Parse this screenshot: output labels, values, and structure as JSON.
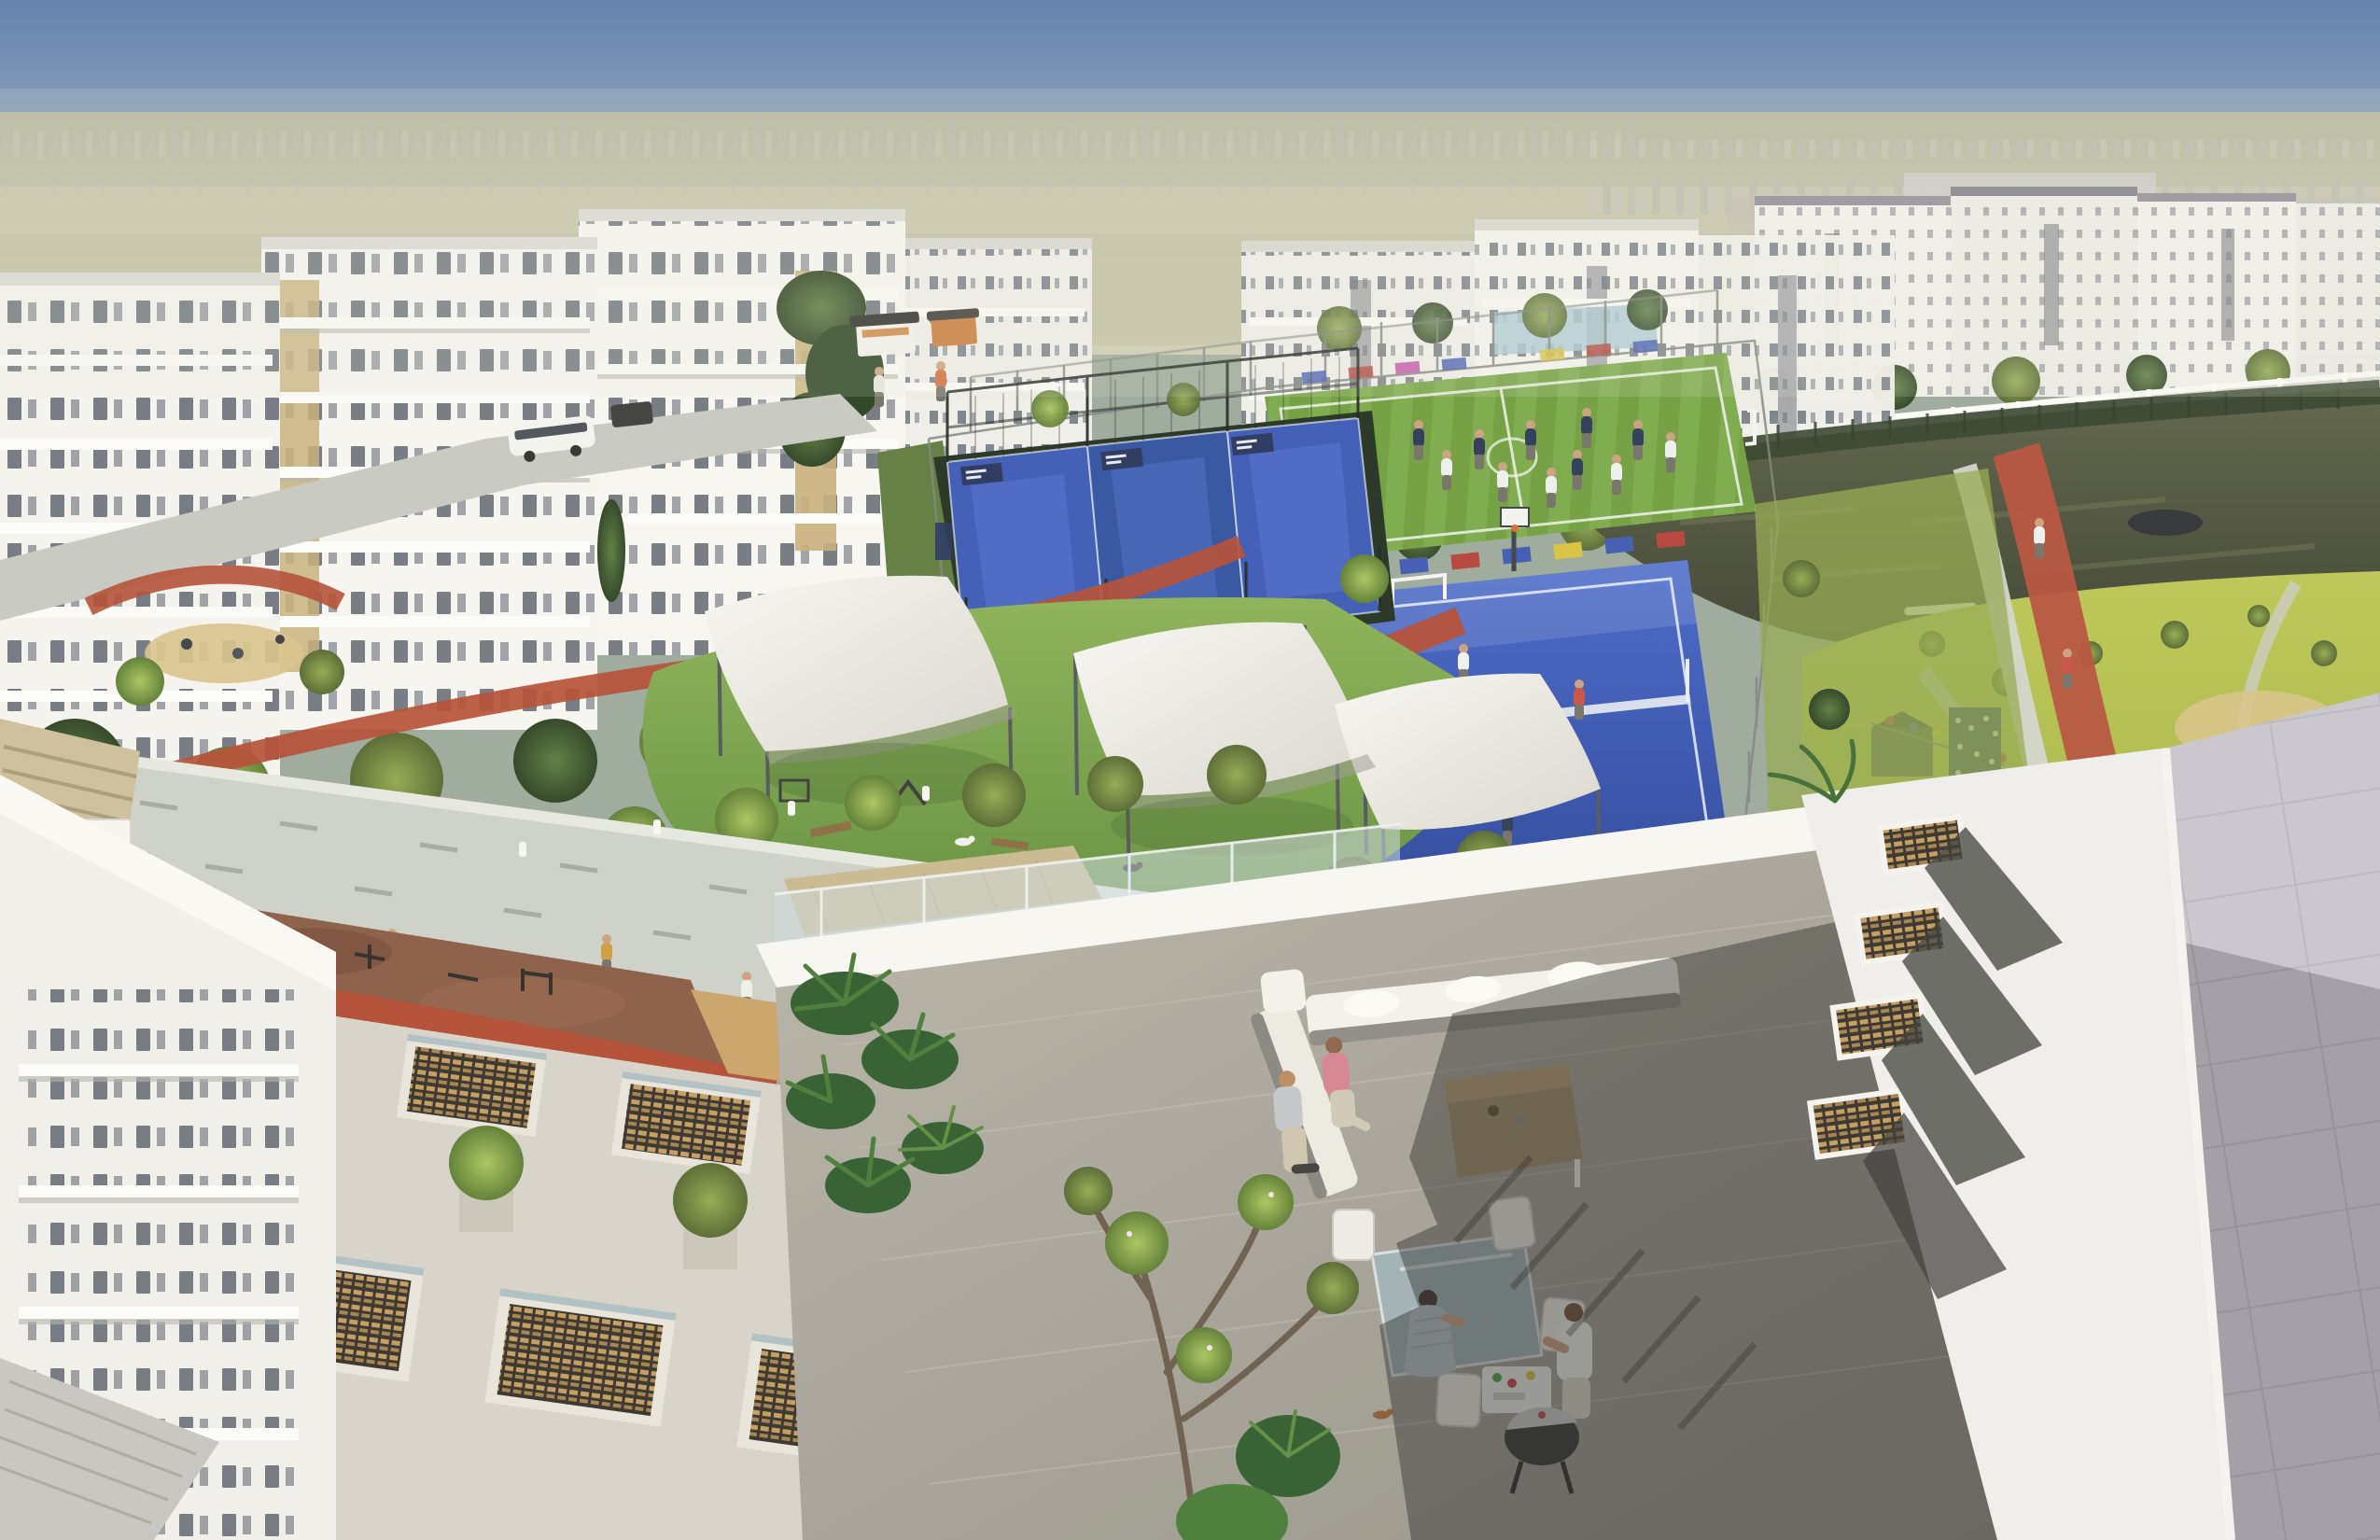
{
  "scene": {
    "title": "Aerial architectural rendering of a residential community with central sports park, lake and foreground rooftop terrace",
    "time_of_day": "sunny daytime",
    "regions": {
      "sky": {
        "label": "hazy blue sky over desert horizon"
      },
      "horizon": {
        "label": "distant city skyline in atmospheric haze"
      },
      "left_buildings": {
        "label": "white low-rise apartment blocks with balconies and stone accent panels"
      },
      "center_buildings": {
        "label": "white apartment blocks across the park"
      },
      "right_buildings": {
        "label": "apartment row along curved lakeside road with white balustrade"
      },
      "lake": {
        "label": "dark reflective lake with reed banks, canoes on shore"
      },
      "meadow": {
        "label": "park meadow with winding paths, adventure playground and climbing wall"
      },
      "football_pitch": {
        "label": "fenced artificial-turf football pitch with players"
      },
      "blue_court": {
        "label": "blue multi-sport court with net and players"
      },
      "padel_courts": {
        "label": "three caged padel courts with blue floors and sign boards"
      },
      "running_track": {
        "label": "terracotta jogging track ribbons winding through the park"
      },
      "dog_park": {
        "label": "dog park lawn shaded by three white tensile sails, dogs and agility gear"
      },
      "promenade": {
        "label": "light stone pedestrian promenade with strollers"
      },
      "fitness_zone": {
        "label": "outdoor gym on brown rubber surfacing"
      },
      "podium_roof": {
        "label": "podium roof with slatted stair skylights and concrete tree planters"
      },
      "left_tower": {
        "label": "foreground white apartment facade at lower left"
      },
      "terrace": {
        "label": "foreground rooftop terrace with lounge sofa, dining set, barbecue and residents"
      },
      "right_roof": {
        "label": "adjacent roof with timber-slat skylights and grey tiled plane in shadow"
      }
    },
    "objects": {
      "shade_sails": 3,
      "padel_courts": 3,
      "football_players": 13,
      "blue_court_players": 7,
      "podium_skylights": 8,
      "roof_skylights": 4,
      "tree_planters": 5,
      "canoes": 2,
      "kiosks": 3,
      "dogs": 5,
      "terrace_people": 5,
      "promenade_people": 12,
      "buses": 1
    },
    "palette": {
      "sky_top": "#5d7cab",
      "sky_horizon": "#c3c9c3",
      "haze": "#cfcbb0",
      "building_white": "#f6f5f1",
      "building_shade": "#dddcd6",
      "window_glass": "#59616b",
      "stone_accent": "#c6ae79",
      "track_red": "#b34a31",
      "pitch_green": "#6f9e3d",
      "court_blue": "#3a58b5",
      "lawn_green": "#6f9c3e",
      "meadow_green": "#aab63f",
      "water_dark": "#4b4f3a",
      "sand_tan": "#d8c288",
      "paver_gray": "#cdd0c7",
      "rubber_brown": "#8a5a44",
      "wood_slat": "#c49a5c",
      "sail_white": "#f3f2ed",
      "concrete_warm": "#b2ada2",
      "roof_tile_gray": "#bcb8c2",
      "shadow_dark": "#2a2927",
      "shirt_pink": "#d4838e",
      "dress_blue_gray": "#b6c2ca",
      "grill_black": "#2f2f2f"
    }
  }
}
